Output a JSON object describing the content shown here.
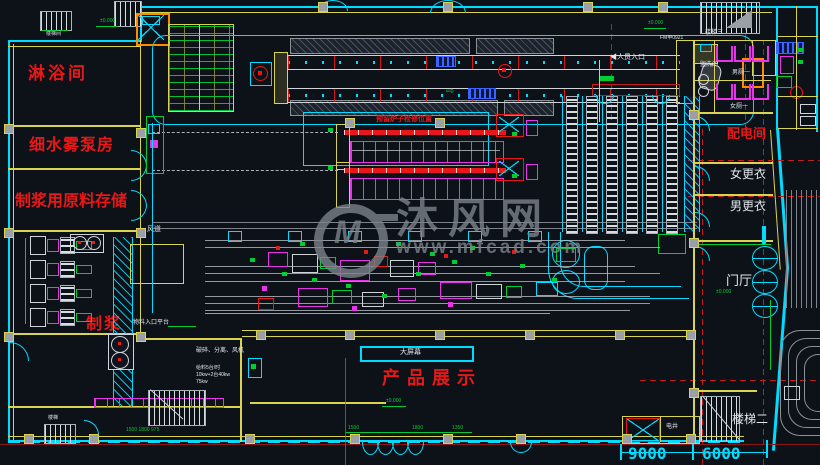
{
  "canvas": {
    "width": 820,
    "height": 465
  },
  "rooms": {
    "shower": "淋浴间",
    "mist_pump_room": "细水雾泵房",
    "raw_material_storage": "制浆用原料存储",
    "pulping": "制浆",
    "air_duct": "风道",
    "power_distribution": "配电间",
    "female_changing": "女更衣",
    "male_changing": "男更衣",
    "lobby": "门厅",
    "stairs_1": "楼梯间",
    "stairs_2": "楼梯二",
    "stairs_3": "楼梯三",
    "stairs_small": "楼梯",
    "washroom": "盥洗间",
    "male_toilet": "男厕一",
    "female_toilet": "女厕一",
    "product_display": "产品展示",
    "big_screen": "大屏幕",
    "shaft": "电井"
  },
  "annotations": {
    "personnel_entrance": "◀人员入口",
    "material_platform": "物料入口平台",
    "furnace_note": "预留炉子检修位置",
    "door_tag": "FM甲0921",
    "equip_note": "破碎、分离、风机",
    "power_note_1": "给料5台/时",
    "power_note_2": "10kw+2台40kw",
    "power_note_3": "75kw"
  },
  "dimensions": {
    "bay_width_1": "9000",
    "bay_width_2": "6000",
    "door_dim_1": "1500",
    "door_dim_2": "1800",
    "door_dim_3": "1350",
    "door_dims_left": "1500 1800 975",
    "elevation_zero": "±0.000"
  },
  "watermark": {
    "logo": "M",
    "brand": "沐风网",
    "url": "www.mfcad.com"
  },
  "icons": {
    "arrow_right": "⇨"
  },
  "colors": {
    "background": "#0d1219",
    "wall_cyan": "#00dcff",
    "wall_yellow": "#d8d351",
    "text_red": "#e81818",
    "dim_green": "#00cc33",
    "equipment_magenta": "#e833e8",
    "axis_red": "#c21d1d",
    "watermark_gray": "#7e848c"
  }
}
